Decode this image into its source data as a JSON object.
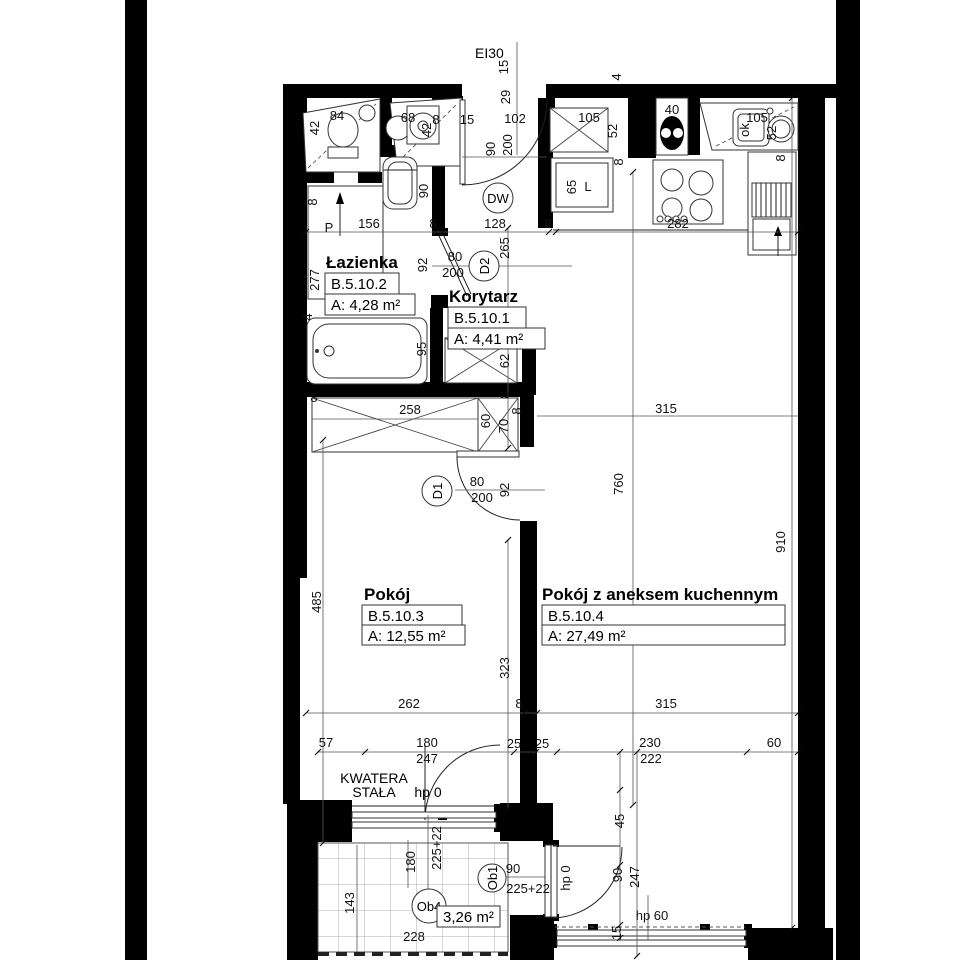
{
  "fire_rating": "EI30",
  "rooms": [
    {
      "name": "Łazienka",
      "id": "B.5.10.2",
      "area": "A: 4,28 m²"
    },
    {
      "name": "Korytarz",
      "id": "B.5.10.1",
      "area": "A: 4,41 m²"
    },
    {
      "name": "Pokój",
      "id": "B.5.10.3",
      "area": "A: 12,55 m²"
    },
    {
      "name": "Pokój z aneksem kuchennym",
      "id": "B.5.10.4",
      "area": "A: 27,49 m²"
    }
  ],
  "balcony": {
    "id": "Ob4",
    "area": "3,26 m²"
  },
  "doors": {
    "entrance": "DW",
    "bathroom": "D2",
    "room": "D1",
    "balcony": "Ob1"
  },
  "window_note": {
    "line1": "KWATERA",
    "line2": "STAŁA",
    "sill": "hp 0"
  },
  "colors": {
    "wall": "#000000",
    "paper": "#ffffff",
    "line": "#555555"
  },
  "labels": [
    {
      "t": "15",
      "x": 504,
      "y": 67,
      "r": 1
    },
    {
      "t": "29",
      "x": 506,
      "y": 97,
      "r": 1
    },
    {
      "t": "15",
      "x": 467,
      "y": 120
    },
    {
      "t": "102",
      "x": 515,
      "y": 119
    },
    {
      "t": "105",
      "x": 589,
      "y": 118
    },
    {
      "t": "52",
      "x": 613,
      "y": 131,
      "r": 1
    },
    {
      "t": "4",
      "x": 617,
      "y": 77,
      "r": 1
    },
    {
      "t": "40",
      "x": 672,
      "y": 110
    },
    {
      "t": "105",
      "x": 757,
      "y": 118
    },
    {
      "t": "ok",
      "x": 745,
      "y": 130,
      "r": 1
    },
    {
      "t": "52",
      "x": 772,
      "y": 133,
      "r": 1
    },
    {
      "t": "8",
      "x": 781,
      "y": 158,
      "r": 1
    },
    {
      "t": "42",
      "x": 315,
      "y": 128,
      "r": 1
    },
    {
      "t": "84",
      "x": 337,
      "y": 116
    },
    {
      "t": "68",
      "x": 408,
      "y": 118
    },
    {
      "t": "42",
      "x": 427,
      "y": 130,
      "r": 1
    },
    {
      "t": "8",
      "x": 436,
      "y": 120
    },
    {
      "t": "8",
      "x": 313,
      "y": 202,
      "r": 1
    },
    {
      "t": "P",
      "x": 329,
      "y": 228,
      "s": 16
    },
    {
      "t": "90",
      "x": 424,
      "y": 191,
      "r": 1
    },
    {
      "t": "90",
      "x": 491,
      "y": 149,
      "r": 1
    },
    {
      "t": "200",
      "x": 508,
      "y": 145,
      "r": 1
    },
    {
      "t": "65",
      "x": 572,
      "y": 187,
      "r": 1
    },
    {
      "t": "L",
      "x": 588,
      "y": 187
    },
    {
      "t": "8",
      "x": 619,
      "y": 162,
      "r": 1
    },
    {
      "t": "156",
      "x": 369,
      "y": 224
    },
    {
      "t": "8",
      "x": 433,
      "y": 224
    },
    {
      "t": "128",
      "x": 495,
      "y": 224
    },
    {
      "t": "8",
      "x": 548,
      "y": 224
    },
    {
      "t": "282",
      "x": 678,
      "y": 224
    },
    {
      "t": "277",
      "x": 315,
      "y": 280,
      "r": 1
    },
    {
      "t": "92",
      "x": 423,
      "y": 265,
      "r": 1
    },
    {
      "t": "80",
      "x": 455,
      "y": 257
    },
    {
      "t": "200",
      "x": 453,
      "y": 273
    },
    {
      "t": "265",
      "x": 505,
      "y": 248,
      "r": 1
    },
    {
      "t": "4",
      "x": 308,
      "y": 317,
      "r": 1
    },
    {
      "t": "95",
      "x": 422,
      "y": 349,
      "r": 1
    },
    {
      "t": "62",
      "x": 505,
      "y": 361,
      "r": 1
    },
    {
      "t": "8",
      "x": 314,
      "y": 398
    },
    {
      "t": "258",
      "x": 410,
      "y": 410
    },
    {
      "t": "60",
      "x": 486,
      "y": 421,
      "r": 1
    },
    {
      "t": "70",
      "x": 504,
      "y": 426,
      "r": 1
    },
    {
      "t": "8",
      "x": 505,
      "y": 395,
      "r": 1
    },
    {
      "t": "8",
      "x": 517,
      "y": 411,
      "r": 1
    },
    {
      "t": "315",
      "x": 666,
      "y": 409
    },
    {
      "t": "760",
      "x": 619,
      "y": 484,
      "r": 1
    },
    {
      "t": "910",
      "x": 781,
      "y": 542,
      "r": 1
    },
    {
      "t": "80",
      "x": 477,
      "y": 482
    },
    {
      "t": "200",
      "x": 482,
      "y": 498
    },
    {
      "t": "92",
      "x": 505,
      "y": 490,
      "r": 1
    },
    {
      "t": "485",
      "x": 317,
      "y": 602,
      "r": 1
    },
    {
      "t": "323",
      "x": 505,
      "y": 668,
      "r": 1
    },
    {
      "t": "262",
      "x": 409,
      "y": 704
    },
    {
      "t": "8",
      "x": 519,
      "y": 704
    },
    {
      "t": "315",
      "x": 666,
      "y": 704
    },
    {
      "t": "57",
      "x": 326,
      "y": 743
    },
    {
      "t": "180",
      "x": 427,
      "y": 743
    },
    {
      "t": "25",
      "x": 514,
      "y": 744
    },
    {
      "t": "25",
      "x": 542,
      "y": 744
    },
    {
      "t": "230",
      "x": 650,
      "y": 743
    },
    {
      "t": "60",
      "x": 774,
      "y": 743
    },
    {
      "t": "247",
      "x": 427,
      "y": 759
    },
    {
      "t": "222",
      "x": 651,
      "y": 759
    },
    {
      "t": "45",
      "x": 620,
      "y": 821,
      "r": 1
    },
    {
      "t": "90",
      "x": 618,
      "y": 875,
      "r": 1
    },
    {
      "t": "247",
      "x": 635,
      "y": 877,
      "r": 1
    },
    {
      "t": "225+22",
      "x": 437,
      "y": 848,
      "r": 1
    },
    {
      "t": "180",
      "x": 411,
      "y": 862,
      "r": 1
    },
    {
      "t": "143",
      "x": 350,
      "y": 903,
      "r": 1
    },
    {
      "t": "90",
      "x": 513,
      "y": 869
    },
    {
      "t": "225+22",
      "x": 528,
      "y": 889
    },
    {
      "t": "hp 0",
      "x": 566,
      "y": 878,
      "r": 1
    },
    {
      "t": "hp 60",
      "x": 652,
      "y": 916,
      "s": 14
    },
    {
      "t": "15",
      "x": 617,
      "y": 933,
      "r": 1
    },
    {
      "t": "228",
      "x": 414,
      "y": 937
    }
  ]
}
